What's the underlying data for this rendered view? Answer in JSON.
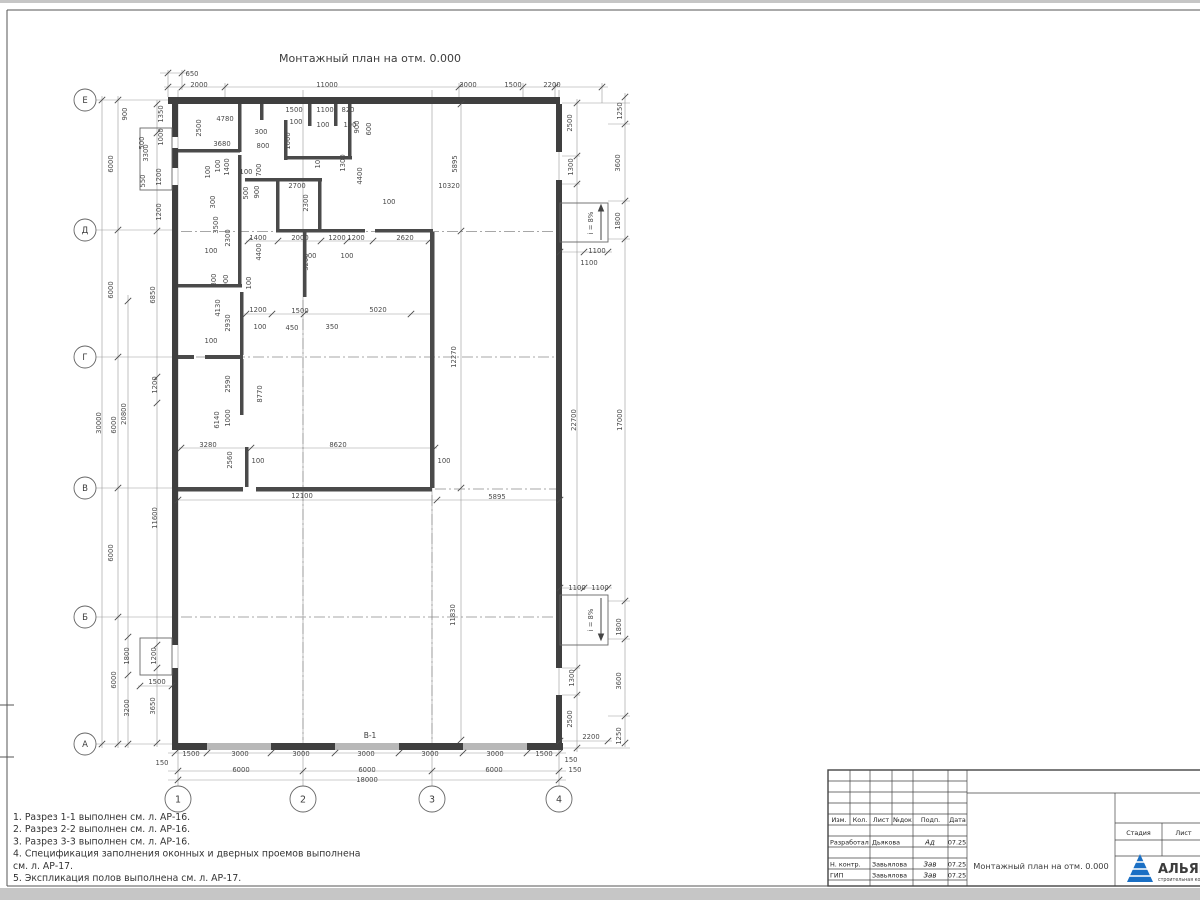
{
  "sheet": {
    "title": "Монтажный план на отм. 0.000",
    "notes": [
      "1. Разрез 1-1 выполнен см. л. АР-16.",
      "2. Разрез 2-2 выполнен см. л. АР-16.",
      "3. Разрез 3-3 выполнен см. л. АР-16.",
      "4. Спецификация заполнения оконных и дверных проемов выполнена",
      "см. л. АР-17.",
      "5. Экспликация полов выполнена см. л. АР-17."
    ]
  },
  "axes": {
    "rows": [
      {
        "label": "Е",
        "y": 100
      },
      {
        "label": "Д",
        "y": 230
      },
      {
        "label": "Г",
        "y": 357
      },
      {
        "label": "В",
        "y": 488
      },
      {
        "label": "Б",
        "y": 617
      },
      {
        "label": "А",
        "y": 744
      }
    ],
    "cols": [
      {
        "label": "1",
        "x": 178
      },
      {
        "label": "2",
        "x": 303
      },
      {
        "label": "3",
        "x": 432
      },
      {
        "label": "4",
        "x": 559
      }
    ]
  },
  "plan": {
    "gate_label": "В-1",
    "ramp_label": "i = 8%",
    "dim_labels": [
      {
        "t": "650",
        "x": 192,
        "y": 74
      },
      {
        "t": "2000",
        "x": 199,
        "y": 85
      },
      {
        "t": "11000",
        "x": 327,
        "y": 85
      },
      {
        "t": "3000",
        "x": 468,
        "y": 85
      },
      {
        "t": "1500",
        "x": 513,
        "y": 85
      },
      {
        "t": "2200",
        "x": 552,
        "y": 85
      },
      {
        "t": "4780",
        "x": 225,
        "y": 119
      },
      {
        "t": "2500",
        "x": 201,
        "y": 128,
        "v": 1
      },
      {
        "t": "3680",
        "x": 222,
        "y": 144
      },
      {
        "t": "300",
        "x": 261,
        "y": 132
      },
      {
        "t": "800",
        "x": 263,
        "y": 146
      },
      {
        "t": "1500",
        "x": 294,
        "y": 110
      },
      {
        "t": "1100",
        "x": 325,
        "y": 110
      },
      {
        "t": "820",
        "x": 348,
        "y": 110
      },
      {
        "t": "100",
        "x": 296,
        "y": 122
      },
      {
        "t": "100",
        "x": 323,
        "y": 125
      },
      {
        "t": "100",
        "x": 350,
        "y": 125
      },
      {
        "t": "900",
        "x": 359,
        "y": 127,
        "v": 1
      },
      {
        "t": "600",
        "x": 371,
        "y": 129,
        "v": 1
      },
      {
        "t": "1000",
        "x": 290,
        "y": 141,
        "v": 1
      },
      {
        "t": "1300",
        "x": 345,
        "y": 163,
        "v": 1
      },
      {
        "t": "100",
        "x": 320,
        "y": 162,
        "v": 1
      },
      {
        "t": "2700",
        "x": 297,
        "y": 186
      },
      {
        "t": "4400",
        "x": 362,
        "y": 176,
        "v": 1
      },
      {
        "t": "2300",
        "x": 308,
        "y": 203,
        "v": 1
      },
      {
        "t": "100",
        "x": 389,
        "y": 202
      },
      {
        "t": "100",
        "x": 220,
        "y": 166,
        "v": 1
      },
      {
        "t": "1400",
        "x": 229,
        "y": 167,
        "v": 1
      },
      {
        "t": "100",
        "x": 210,
        "y": 172,
        "v": 1
      },
      {
        "t": "100",
        "x": 246,
        "y": 172
      },
      {
        "t": "700",
        "x": 261,
        "y": 170,
        "v": 1
      },
      {
        "t": "500",
        "x": 248,
        "y": 193,
        "v": 1
      },
      {
        "t": "900",
        "x": 259,
        "y": 192,
        "v": 1
      },
      {
        "t": "300",
        "x": 215,
        "y": 202,
        "v": 1
      },
      {
        "t": "3500",
        "x": 218,
        "y": 225,
        "v": 1
      },
      {
        "t": "2300",
        "x": 230,
        "y": 238,
        "v": 1
      },
      {
        "t": "1400",
        "x": 258,
        "y": 238
      },
      {
        "t": "2000",
        "x": 300,
        "y": 238
      },
      {
        "t": "1200",
        "x": 337,
        "y": 238
      },
      {
        "t": "1200",
        "x": 356,
        "y": 238
      },
      {
        "t": "2620",
        "x": 405,
        "y": 238
      },
      {
        "t": "100",
        "x": 310,
        "y": 256
      },
      {
        "t": "100",
        "x": 347,
        "y": 256
      },
      {
        "t": "3200",
        "x": 308,
        "y": 262,
        "v": 1
      },
      {
        "t": "4400",
        "x": 261,
        "y": 252,
        "v": 1
      },
      {
        "t": "100",
        "x": 211,
        "y": 251
      },
      {
        "t": "300",
        "x": 216,
        "y": 280,
        "v": 1
      },
      {
        "t": "900",
        "x": 228,
        "y": 281,
        "v": 1
      },
      {
        "t": "100",
        "x": 251,
        "y": 283,
        "v": 1
      },
      {
        "t": "4130",
        "x": 220,
        "y": 308,
        "v": 1
      },
      {
        "t": "2930",
        "x": 230,
        "y": 323,
        "v": 1
      },
      {
        "t": "1200",
        "x": 258,
        "y": 310
      },
      {
        "t": "100",
        "x": 260,
        "y": 327
      },
      {
        "t": "1500",
        "x": 300,
        "y": 311
      },
      {
        "t": "450",
        "x": 292,
        "y": 328
      },
      {
        "t": "350",
        "x": 332,
        "y": 327
      },
      {
        "t": "5020",
        "x": 378,
        "y": 310
      },
      {
        "t": "100",
        "x": 211,
        "y": 341
      },
      {
        "t": "2590",
        "x": 230,
        "y": 384,
        "v": 1
      },
      {
        "t": "8770",
        "x": 262,
        "y": 394,
        "v": 1
      },
      {
        "t": "6140",
        "x": 219,
        "y": 420,
        "v": 1
      },
      {
        "t": "1000",
        "x": 230,
        "y": 418,
        "v": 1
      },
      {
        "t": "3280",
        "x": 208,
        "y": 445
      },
      {
        "t": "8620",
        "x": 338,
        "y": 445
      },
      {
        "t": "2560",
        "x": 232,
        "y": 460,
        "v": 1
      },
      {
        "t": "100",
        "x": 258,
        "y": 461
      },
      {
        "t": "100",
        "x": 444,
        "y": 461
      },
      {
        "t": "12100",
        "x": 302,
        "y": 496
      },
      {
        "t": "5895",
        "x": 497,
        "y": 497
      },
      {
        "t": "12270",
        "x": 456,
        "y": 357,
        "v": 1
      },
      {
        "t": "5895",
        "x": 457,
        "y": 164,
        "v": 1
      },
      {
        "t": "10320",
        "x": 449,
        "y": 186
      },
      {
        "t": "11830",
        "x": 455,
        "y": 615,
        "v": 1
      },
      {
        "t": "900",
        "x": 127,
        "y": 114,
        "v": 1
      },
      {
        "t": "1350",
        "x": 163,
        "y": 114,
        "v": 1
      },
      {
        "t": "3300",
        "x": 148,
        "y": 153,
        "v": 1
      },
      {
        "t": "500",
        "x": 144,
        "y": 143,
        "v": 1
      },
      {
        "t": "1000",
        "x": 163,
        "y": 137,
        "v": 1
      },
      {
        "t": "550",
        "x": 145,
        "y": 181,
        "v": 1
      },
      {
        "t": "1200",
        "x": 161,
        "y": 177,
        "v": 1
      },
      {
        "t": "1200",
        "x": 161,
        "y": 212,
        "v": 1
      },
      {
        "t": "6000",
        "x": 113,
        "y": 164,
        "v": 1
      },
      {
        "t": "6000",
        "x": 113,
        "y": 290,
        "v": 1
      },
      {
        "t": "6850",
        "x": 155,
        "y": 295,
        "v": 1
      },
      {
        "t": "1200",
        "x": 157,
        "y": 385,
        "v": 1
      },
      {
        "t": "30000",
        "x": 101,
        "y": 423,
        "v": 1
      },
      {
        "t": "20800",
        "x": 126,
        "y": 414,
        "v": 1
      },
      {
        "t": "6000",
        "x": 116,
        "y": 425,
        "v": 1
      },
      {
        "t": "6000",
        "x": 113,
        "y": 553,
        "v": 1
      },
      {
        "t": "11600",
        "x": 157,
        "y": 518,
        "v": 1
      },
      {
        "t": "6000",
        "x": 116,
        "y": 680,
        "v": 1
      },
      {
        "t": "1800",
        "x": 129,
        "y": 656,
        "v": 1
      },
      {
        "t": "1200",
        "x": 156,
        "y": 656,
        "v": 1
      },
      {
        "t": "1500",
        "x": 157,
        "y": 682
      },
      {
        "t": "3200",
        "x": 129,
        "y": 708,
        "v": 1
      },
      {
        "t": "3650",
        "x": 155,
        "y": 706,
        "v": 1
      },
      {
        "t": "150",
        "x": 162,
        "y": 763
      },
      {
        "t": "1500",
        "x": 191,
        "y": 754
      },
      {
        "t": "3000",
        "x": 240,
        "y": 754
      },
      {
        "t": "3000",
        "x": 301,
        "y": 754
      },
      {
        "t": "3000",
        "x": 366,
        "y": 754
      },
      {
        "t": "3000",
        "x": 430,
        "y": 754
      },
      {
        "t": "3000",
        "x": 495,
        "y": 754
      },
      {
        "t": "1500",
        "x": 544,
        "y": 754
      },
      {
        "t": "150",
        "x": 575,
        "y": 770
      },
      {
        "t": "6000",
        "x": 241,
        "y": 770
      },
      {
        "t": "6000",
        "x": 367,
        "y": 770
      },
      {
        "t": "6000",
        "x": 494,
        "y": 770
      },
      {
        "t": "18000",
        "x": 367,
        "y": 780
      },
      {
        "t": "1250",
        "x": 622,
        "y": 111,
        "v": 1
      },
      {
        "t": "2500",
        "x": 572,
        "y": 123,
        "v": 1
      },
      {
        "t": "3600",
        "x": 620,
        "y": 163,
        "v": 1
      },
      {
        "t": "1300",
        "x": 573,
        "y": 167,
        "v": 1
      },
      {
        "t": "1800",
        "x": 620,
        "y": 221,
        "v": 1
      },
      {
        "t": "1100",
        "x": 597,
        "y": 251
      },
      {
        "t": "1100",
        "x": 589,
        "y": 263
      },
      {
        "t": "22700",
        "x": 576,
        "y": 420,
        "v": 1
      },
      {
        "t": "17000",
        "x": 622,
        "y": 420,
        "v": 1
      },
      {
        "t": "1100",
        "x": 577,
        "y": 588
      },
      {
        "t": "1100",
        "x": 600,
        "y": 588
      },
      {
        "t": "1800",
        "x": 621,
        "y": 627,
        "v": 1
      },
      {
        "t": "1300",
        "x": 574,
        "y": 678,
        "v": 1
      },
      {
        "t": "3600",
        "x": 621,
        "y": 681,
        "v": 1
      },
      {
        "t": "2500",
        "x": 572,
        "y": 719,
        "v": 1
      },
      {
        "t": "2200",
        "x": 591,
        "y": 737
      },
      {
        "t": "1250",
        "x": 621,
        "y": 736,
        "v": 1
      },
      {
        "t": "150",
        "x": 571,
        "y": 760
      }
    ]
  },
  "titleblock": {
    "rev_headers": [
      "Изм.",
      "Кол.",
      "Лист",
      "№док",
      "Подп.",
      "Дата"
    ],
    "people": [
      {
        "role": "Разработал",
        "name": "Дьякова",
        "sig": "Ад",
        "date": "07.25"
      },
      {
        "role": "Н. контр.",
        "name": "Завьялова",
        "sig": "Зав",
        "date": "07.25"
      },
      {
        "role": "ГИП",
        "name": "Завьялова",
        "sig": "Зав",
        "date": "07.25"
      }
    ],
    "doc_title": "Монтажный план на отм. 0.000",
    "stage_headers": [
      "Стадия",
      "Лист",
      "Лис"
    ],
    "company": "АЛЬЯН",
    "company_sub": "строительная ком"
  }
}
